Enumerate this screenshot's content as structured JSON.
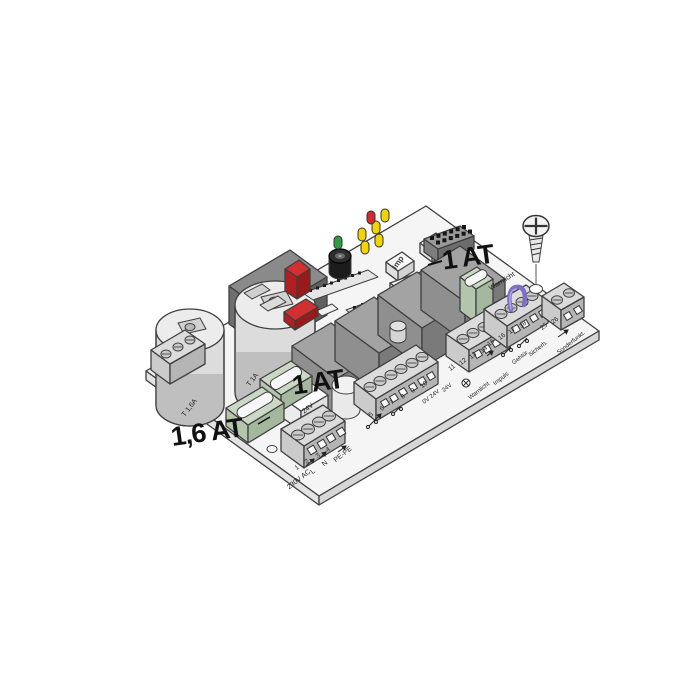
{
  "figure_type": "control-board-technical-illustration",
  "annotations": {
    "fuse_16at": "1,6 AT",
    "fuse_1at_mid": "1 AT",
    "fuse_1at_right": "1 AT"
  },
  "buttons": {
    "imp": "Imp",
    "geh": "Geh"
  },
  "silkscreen": {
    "t16a": "T 1,6A",
    "t1a": "T 1A",
    "v24": "24V",
    "warnlicht_edge": "Warnlicht"
  },
  "terminals": {
    "mains": {
      "numbers": [
        "1",
        "2",
        "3",
        "4"
      ],
      "line": "230V AC",
      "l": "L",
      "n": "N",
      "pe": "PE-PE"
    },
    "lv": {
      "numbers": [
        "5",
        "6",
        "7",
        "8",
        "9",
        "10"
      ],
      "label1": "0V 24V",
      "label2": "24V"
    },
    "sig1": {
      "numbers": [
        "11",
        "12",
        "13",
        "14"
      ],
      "label1": "Warnlicht",
      "label2": "Impuls"
    },
    "sig2": {
      "numbers": [
        "15",
        "16",
        "17",
        "18"
      ],
      "label1": "Gehtür",
      "label2": "Sicherh."
    },
    "aux": {
      "numbers": [
        "25",
        "26"
      ],
      "label1": "Sonderfunkt."
    }
  },
  "leds": {
    "green": 1,
    "yellow": 5,
    "red": 1
  },
  "colors": {
    "background": "#ffffff",
    "board": "#f5f5f5",
    "outline": "#3f3f3f",
    "relay_top": "#a3a3a3",
    "relay_front": "#7a7a7a",
    "fuse_green": "#ccd8c6",
    "fuse_red": "#d23030",
    "led_green": "#2f9e3f",
    "led_yellow": "#f2d400",
    "led_red": "#d42a2a",
    "jumper_purple": "#7f6fc4",
    "annotation": "#111111"
  }
}
